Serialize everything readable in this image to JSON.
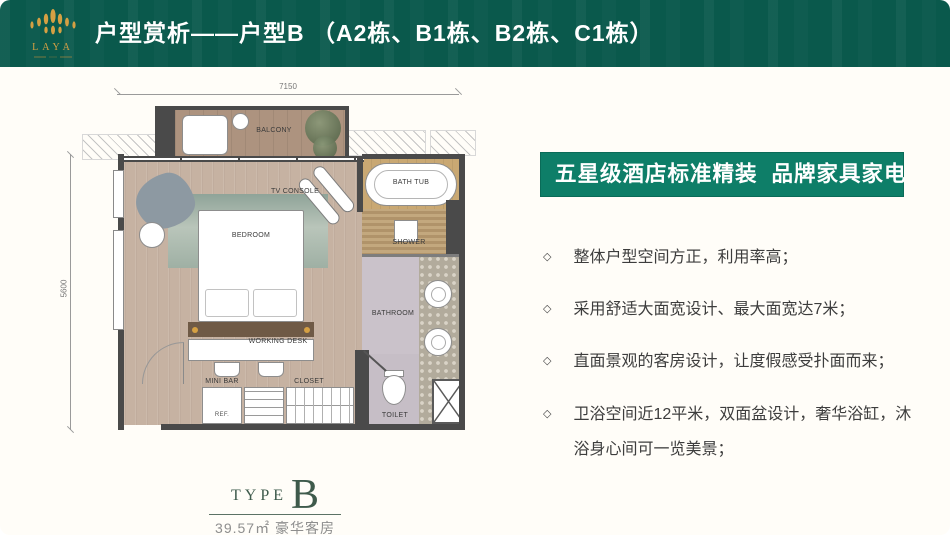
{
  "header": {
    "logo_text": "LAYA",
    "title": "户型赏析——户型B （A2栋、B1栋、B2栋、C1栋）"
  },
  "plan": {
    "dims": {
      "width": "7150",
      "height": "5600"
    },
    "labels": {
      "balcony": "BALCONY",
      "bath_tub": "BATH TUB",
      "tv_console": "TV CONSOLE",
      "bedroom": "BEDROOM",
      "shower": "SHOWER",
      "bathroom": "BATHROOM",
      "working_desk": "WORKING DESK",
      "mini_bar": "MINI BAR",
      "closet": "CLOSET",
      "ref": "REF.",
      "toilet": "TOILET"
    }
  },
  "type_block": {
    "prefix": "TYPE",
    "letter": "B",
    "area": "39.57㎡",
    "room": "豪华客房"
  },
  "banner": {
    "text": "五星级酒店标准精装  品牌家具家电"
  },
  "features": [
    "整体户型空间方正，利用率高；",
    "采用舒适大面宽设计、最大面宽达7米；",
    "直面景观的客房设计，让度假感受扑面而来；",
    "卫浴空间近12平米，双面盆设计，奢华浴缸，沐浴身心间可一览美景；"
  ],
  "ui": {
    "bullet_glyph": "◇"
  },
  "colors": {
    "header_teal": "#0a594c",
    "banner_green": "#0e7e68",
    "brand_gold": "#d5a043",
    "type_green": "#3e5a4b"
  }
}
